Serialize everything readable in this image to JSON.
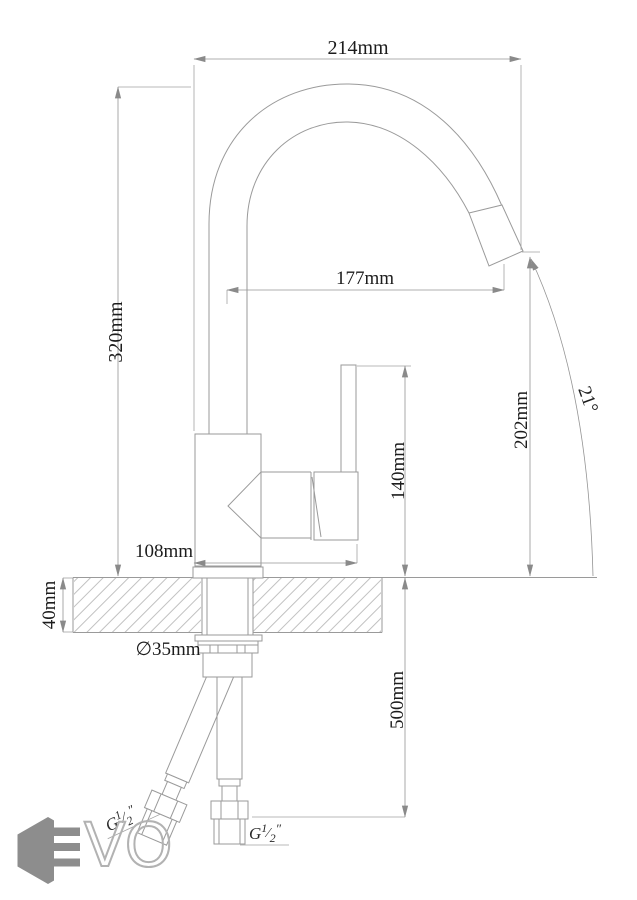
{
  "drawing": {
    "dimensions": {
      "total_width": "214mm",
      "total_height": "320mm",
      "spout_reach": "177mm",
      "spout_outlet_height": "202mm",
      "spout_angle": "21°",
      "handle_height": "140mm",
      "body_depth": "108mm",
      "counter_thickness": "40mm",
      "hole_diameter": "∅35mm",
      "hose_length": "500mm"
    },
    "thread": {
      "prefix": "G",
      "numerator": "1",
      "fraction_slash": "⁄",
      "denominator": "2",
      "inches_mark": "″"
    },
    "logo": {
      "outline_letters": "VO"
    }
  }
}
